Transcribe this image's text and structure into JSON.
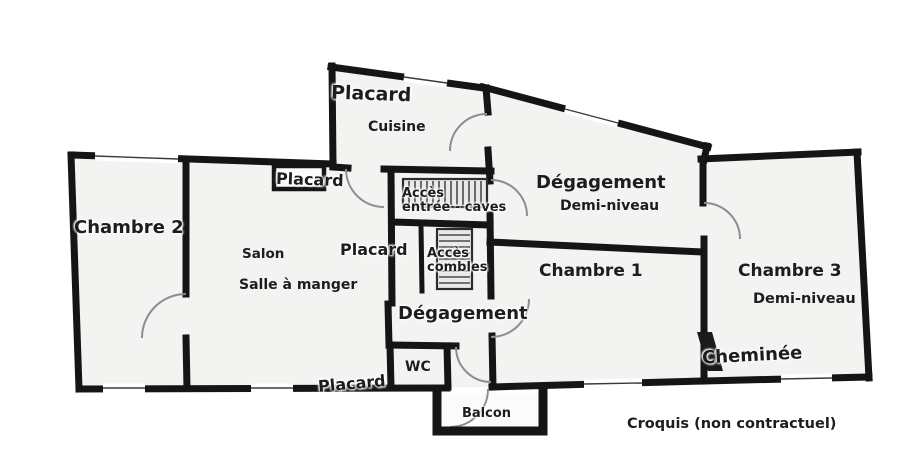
{
  "colors": {
    "wall": "#151515",
    "door_arc": "#8d8d8d",
    "room_fill": "#f3f3f2",
    "stairs_fill": "#e9e9e9",
    "background": "#ffffff",
    "text": "#1d1d1d"
  },
  "plan": {
    "labels": {
      "placard_kitchen": "Placard",
      "cuisine": "Cuisine",
      "placard_entry": "Placard",
      "chambre2": "Chambre 2",
      "salon": "Salon",
      "salle_a_manger": "Salle à manger",
      "placard_center": "Placard",
      "acces_caves_line1": "Accès",
      "acces_caves_line2": "entrée - caves",
      "acces_combles_line1": "Accès",
      "acces_combles_line2": "combles",
      "degagement_haut": "Dégagement",
      "demi_niveau_haut": "Demi-niveau",
      "chambre1": "Chambre 1",
      "chambre3": "Chambre 3",
      "demi_niveau_chambre3": "Demi-niveau",
      "cheminee": "Cheminée",
      "degagement_bas": "Dégagement",
      "wc": "WC",
      "placard_bas": "Placard",
      "balcon": "Balcon"
    },
    "caption": "Croquis (non contractuel)"
  }
}
